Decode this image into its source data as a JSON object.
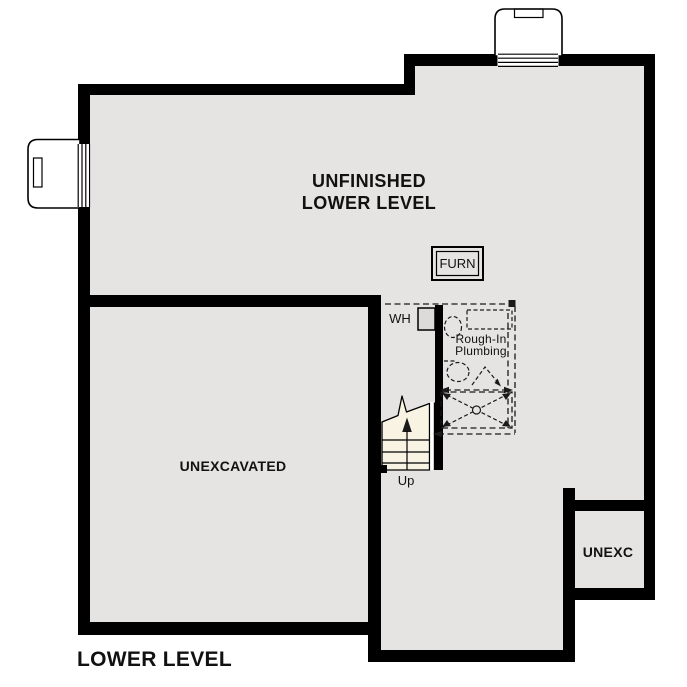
{
  "title": "LOWER LEVEL",
  "rooms": {
    "main": {
      "line1": "UNFINISHED",
      "line2": "LOWER LEVEL"
    },
    "unexcavated": {
      "label": "UNEXCAVATED"
    },
    "unexc": {
      "label": "UNEXC"
    }
  },
  "fixtures": {
    "furnace": {
      "label": "FURN"
    },
    "water_heater": {
      "label": "WH"
    },
    "rough_in": {
      "line1": "Rough-In",
      "line2": "Plumbing"
    }
  },
  "stairs": {
    "direction": "Up"
  },
  "colors": {
    "wall": "#000000",
    "floor": "#e6e4e2",
    "stairs_fill": "#f8f3e3",
    "line": "#1a1a1a",
    "background": "#ffffff"
  }
}
